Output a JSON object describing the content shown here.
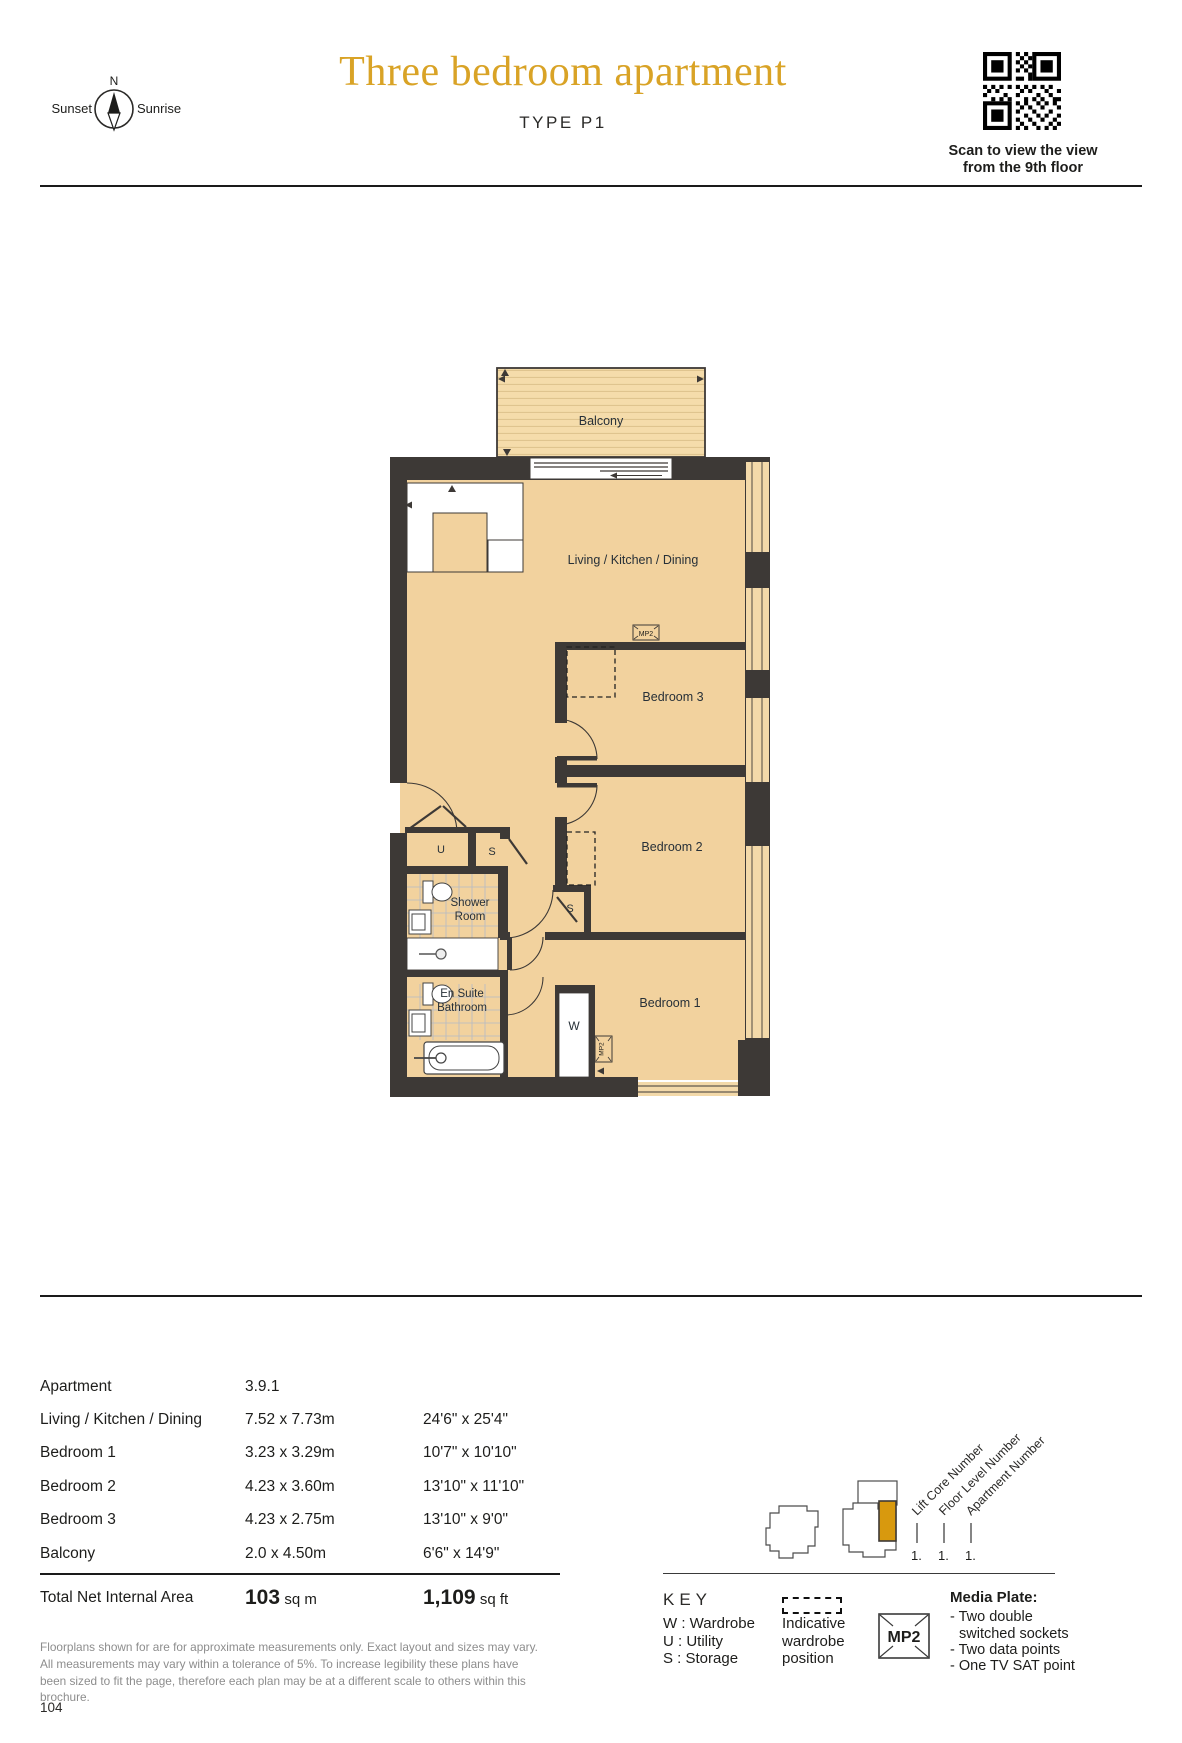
{
  "header": {
    "compass": {
      "north": "N",
      "left": "Sunset",
      "right": "Sunrise"
    },
    "title": "Three bedroom apartment",
    "subtitle": "TYPE P1",
    "qr_caption_line1": "Scan to view the view",
    "qr_caption_line2": "from the 9th floor"
  },
  "floorplan": {
    "labels": {
      "balcony": "Balcony",
      "living": "Living / Kitchen / Dining",
      "bedroom3": "Bedroom 3",
      "bedroom2": "Bedroom 2",
      "bedroom1": "Bedroom 1",
      "shower_line1": "Shower",
      "shower_line2": "Room",
      "ensuite_line1": "En Suite",
      "ensuite_line2": "Bathroom",
      "utility": "U",
      "storage_a": "S",
      "storage_b": "S",
      "wardrobe": "W",
      "mp2_tag1": "MP2",
      "mp2_tag2": "MP2"
    }
  },
  "dimensions_table": {
    "rows": [
      {
        "label": "Apartment",
        "metric": "3.9.1",
        "imperial": ""
      },
      {
        "label": "Living / Kitchen / Dining",
        "metric": "7.52 x 7.73m",
        "imperial": "24'6\" x 25'4\""
      },
      {
        "label": "Bedroom 1",
        "metric": "3.23 x 3.29m",
        "imperial": "10'7\" x 10'10\""
      },
      {
        "label": "Bedroom 2",
        "metric": "4.23 x 3.60m",
        "imperial": "13'10\" x 11'10\""
      },
      {
        "label": "Bedroom 3",
        "metric": "4.23 x 2.75m",
        "imperial": "13'10\" x 9'0\""
      },
      {
        "label": "Balcony",
        "metric": "2.0 x 4.50m",
        "imperial": "6'6\" x 14'9\""
      }
    ],
    "total": {
      "label": "Total Net Internal Area",
      "metric_value": "103",
      "metric_unit": "sq m",
      "imperial_value": "1,109",
      "imperial_unit": "sq ft"
    }
  },
  "disclaimer": "Floorplans shown for are for approximate measurements only. Exact layout and sizes may vary. All measurements may vary within a tolerance of 5%. To increase legibility these plans have been sized to fit the page, therefore each plan may be at a different scale to others within this brochure.",
  "locator": {
    "labels": [
      "Lift Core Number",
      "Floor Level Number",
      "Apartment Number"
    ],
    "values": [
      "1.",
      "1.",
      "1."
    ]
  },
  "key": {
    "heading": "KEY",
    "items": [
      "W : Wardrobe",
      "U : Utility",
      "S : Storage"
    ],
    "wardrobe_note_lines": [
      "Indicative",
      "wardrobe",
      "position"
    ],
    "mp2_label": "MP2",
    "media_plate_heading": "Media Plate:",
    "media_plate_items": [
      "- Two double",
      "switched sockets",
      "- Two data points",
      "- One TV SAT point"
    ]
  },
  "page_number": "104",
  "colors": {
    "accent_gold": "#D9A326",
    "highlight_gold": "#D8990E",
    "wall": "#3d3936",
    "floor": "#f2d29e"
  }
}
